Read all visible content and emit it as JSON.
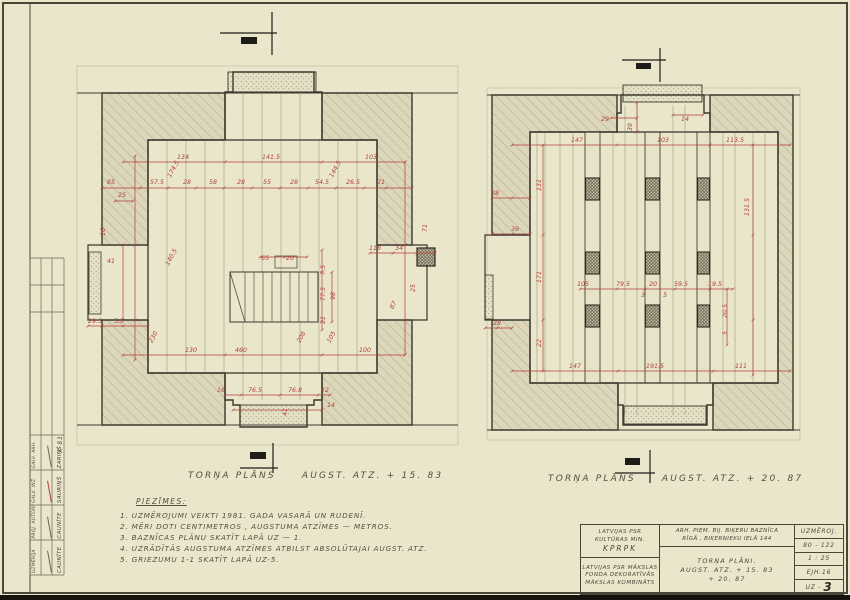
{
  "sheet": {
    "paper": "#eae6cc",
    "ink": "#4a463a",
    "red": "#b0403a"
  },
  "plans": {
    "left": {
      "caption": {
        "name": "TORŅA PLĀNS",
        "elev": "AUGST. ATZ.  + 15. 83"
      },
      "dims": [
        {
          "t": "134",
          "x": 108,
          "y": 99
        },
        {
          "t": "141.5",
          "x": 196,
          "y": 99
        },
        {
          "t": "103",
          "x": 296,
          "y": 99
        },
        {
          "t": "65",
          "x": 36,
          "y": 124
        },
        {
          "t": "57.5",
          "x": 82,
          "y": 124
        },
        {
          "t": "28",
          "x": 112,
          "y": 124
        },
        {
          "t": "58",
          "x": 138,
          "y": 124
        },
        {
          "t": "28",
          "x": 166,
          "y": 124
        },
        {
          "t": "55",
          "x": 192,
          "y": 124
        },
        {
          "t": "28",
          "x": 219,
          "y": 124
        },
        {
          "t": "54.5",
          "x": 247,
          "y": 124
        },
        {
          "t": "26.5",
          "x": 278,
          "y": 124
        },
        {
          "t": "21",
          "x": 306,
          "y": 124
        },
        {
          "t": "25",
          "x": 47,
          "y": 137
        },
        {
          "t": "174.5",
          "x": 100,
          "y": 110,
          "r": -62
        },
        {
          "t": "144.5",
          "x": 262,
          "y": 110,
          "r": -62
        },
        {
          "t": "41",
          "x": 36,
          "y": 203
        },
        {
          "t": "16",
          "x": 30,
          "y": 172,
          "r": -90
        },
        {
          "t": "140.5",
          "x": 98,
          "y": 198,
          "r": -62
        },
        {
          "t": "29.5",
          "x": 20,
          "y": 263
        },
        {
          "t": "5.5",
          "x": 44,
          "y": 263
        },
        {
          "t": "230",
          "x": 80,
          "y": 278,
          "r": -62
        },
        {
          "t": "130",
          "x": 116,
          "y": 292
        },
        {
          "t": "460",
          "x": 166,
          "y": 292
        },
        {
          "t": "100",
          "x": 290,
          "y": 292
        },
        {
          "t": "206",
          "x": 228,
          "y": 278,
          "r": -62
        },
        {
          "t": "105",
          "x": 258,
          "y": 278,
          "r": -62
        },
        {
          "t": "65",
          "x": 190,
          "y": 200
        },
        {
          "t": "20",
          "x": 215,
          "y": 200
        },
        {
          "t": "7.5",
          "x": 250,
          "y": 210,
          "r": -90
        },
        {
          "t": "77.5",
          "x": 250,
          "y": 234,
          "r": -90
        },
        {
          "t": "98",
          "x": 260,
          "y": 236,
          "r": -90
        },
        {
          "t": "21",
          "x": 250,
          "y": 260,
          "r": -90
        },
        {
          "t": "16",
          "x": 146,
          "y": 332
        },
        {
          "t": "76.5",
          "x": 180,
          "y": 332
        },
        {
          "t": "76.8",
          "x": 220,
          "y": 332
        },
        {
          "t": "12",
          "x": 250,
          "y": 332
        },
        {
          "t": "14",
          "x": 256,
          "y": 347
        },
        {
          "t": "41",
          "x": 212,
          "y": 352,
          "r": -90
        },
        {
          "t": "118",
          "x": 300,
          "y": 190
        },
        {
          "t": "34",
          "x": 324,
          "y": 190
        },
        {
          "t": "71",
          "x": 352,
          "y": 168,
          "r": -90
        },
        {
          "t": "25",
          "x": 340,
          "y": 228,
          "r": -90
        },
        {
          "t": "87",
          "x": 320,
          "y": 246,
          "r": -62
        }
      ]
    },
    "right": {
      "caption": {
        "name": "TORŅA PLĀNS",
        "elev": "AUGST. ATZ.  + 20. 87"
      },
      "dims": [
        {
          "t": "29",
          "x": 120,
          "y": 36
        },
        {
          "t": "39",
          "x": 147,
          "y": 42,
          "r": -90
        },
        {
          "t": "14",
          "x": 200,
          "y": 36
        },
        {
          "t": "147",
          "x": 92,
          "y": 57
        },
        {
          "t": "103",
          "x": 178,
          "y": 57
        },
        {
          "t": "113.5",
          "x": 250,
          "y": 57
        },
        {
          "t": "28",
          "x": 10,
          "y": 110
        },
        {
          "t": "131",
          "x": 56,
          "y": 100,
          "r": -90
        },
        {
          "t": "39",
          "x": 30,
          "y": 146
        },
        {
          "t": "171",
          "x": 56,
          "y": 192,
          "r": -90
        },
        {
          "t": "22",
          "x": 56,
          "y": 258,
          "r": -90
        },
        {
          "t": "105",
          "x": 98,
          "y": 201
        },
        {
          "t": "79.5",
          "x": 138,
          "y": 201
        },
        {
          "t": "20",
          "x": 168,
          "y": 201
        },
        {
          "t": "59.5",
          "x": 196,
          "y": 201
        },
        {
          "t": "19.5",
          "x": 230,
          "y": 201
        },
        {
          "t": "3",
          "x": 158,
          "y": 212
        },
        {
          "t": "5",
          "x": 180,
          "y": 212
        },
        {
          "t": "131.5",
          "x": 264,
          "y": 122,
          "r": -90
        },
        {
          "t": "20.5",
          "x": 242,
          "y": 226,
          "r": -90
        },
        {
          "t": "5",
          "x": 242,
          "y": 248,
          "r": -90
        },
        {
          "t": "147",
          "x": 90,
          "y": 283
        },
        {
          "t": "191.5",
          "x": 170,
          "y": 283
        },
        {
          "t": "111",
          "x": 256,
          "y": 283
        },
        {
          "t": "28",
          "x": 12,
          "y": 240
        }
      ]
    }
  },
  "notes": {
    "header": "PIEZĪMES:",
    "items": [
      "1.  UZMĒROJUMI  VEIKTI  1981. GADA  VASARĀ  UN  RUDENĪ.",
      "2.  MĒRI  DOTI  CENTIMETROS ,  AUGSTUMA  ATZĪMES  —  METROS.",
      "3.  BAZNĪCAS  PLĀNU  SKATĪT  LAPĀ  UZ — 1.",
      "4.  UZRĀDĪTĀS  AUGSTUMA  ATZĪMES  ATBILST  ABSOLŪTAJAI  AUGST. ATZ.",
      "5.  GRIEZUMU  1-1  SKATĪT  LAPĀ  UZ-5."
    ]
  },
  "titleblock": {
    "org_top_1": "LATVIJAS PSR",
    "org_top_2": "KULTŪRAS MIN.",
    "org_top_3": "KPRPK",
    "org_bottom_1": "LATVIJAS PSR MĀKSLAS",
    "org_bottom_2": "FONDA DEKORATĪVĀS",
    "org_bottom_3": "MĀKSLAS KOMBINĀTS",
    "object_1": "ARH. PIEM. BIJ. BIĶERU BAZNĪCA",
    "object_2": "RĪGĀ , BIĶERNIEKU IELĀ 144",
    "sheet_title_1": "TORŅA  PLĀNI.",
    "sheet_title_2": "AUGST. ATZ.   + 15. 83",
    "sheet_title_3": "+ 20. 87",
    "meta_label": "UZMĒROJ.",
    "meta_number": "80 - 122",
    "meta_scale": "1 : 25",
    "meta_code": "EJH.16",
    "meta_sheet_prefix": "UZ -",
    "meta_sheet_big": "3"
  },
  "sigtable": {
    "date": "X 81",
    "rows": [
      {
        "role": "GALV. ARH.",
        "name": "ZARIŅŠ"
      },
      {
        "role": "GALV. INŽ.",
        "name": "SAURIŅŠ"
      },
      {
        "role": "PROJ. AUTORI",
        "name": "CAUNĪTE"
      },
      {
        "role": "UZMĒRĪJA",
        "name": "CAUNĪTE"
      }
    ]
  }
}
